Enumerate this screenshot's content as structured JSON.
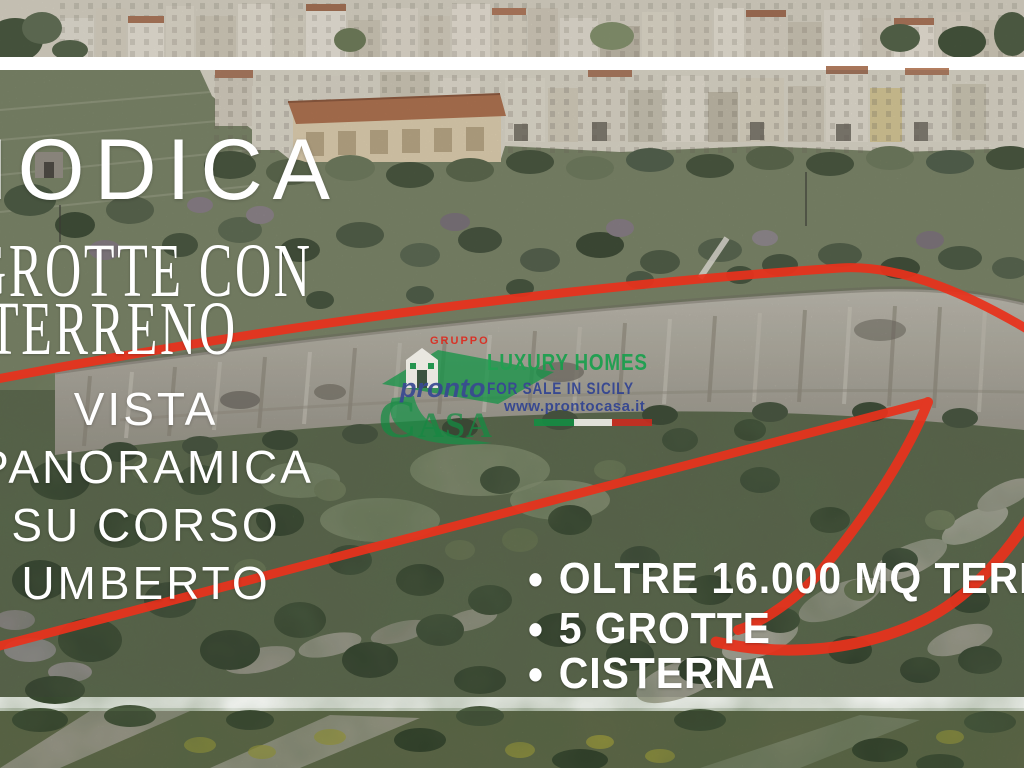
{
  "overlay": {
    "title": "MODICA",
    "subtitle_line1": "GROTTE CON",
    "subtitle_line2": "TERRENO",
    "side_lines": [
      "VISTA",
      "PANORAMICA",
      "SU CORSO",
      "UMBERTO"
    ],
    "features": [
      {
        "bullet": "•",
        "text": "OLTRE 16.000 MQ TERRENO"
      },
      {
        "bullet": "•",
        "text": "5 GROTTE"
      },
      {
        "bullet": "•",
        "text": "CISTERNA"
      }
    ]
  },
  "watermark": {
    "gruppo_label": "GRUPPO",
    "brand_pronto": "pronto",
    "brand_casa": "CASA",
    "tagline_line1": "LUXURY HOMES",
    "tagline_line2": "FOR SALE IN SICILY",
    "website": "www.prontocasa.it",
    "flag_colors": [
      "#148f43",
      "#f5f3ee",
      "#cd2a1e"
    ]
  },
  "colors": {
    "boundary": "#e8321c",
    "overlay_text": "#ffffff",
    "watermark_green": "#13a04a",
    "watermark_blue": "#2c3f92",
    "watermark_red": "#e02418"
  }
}
